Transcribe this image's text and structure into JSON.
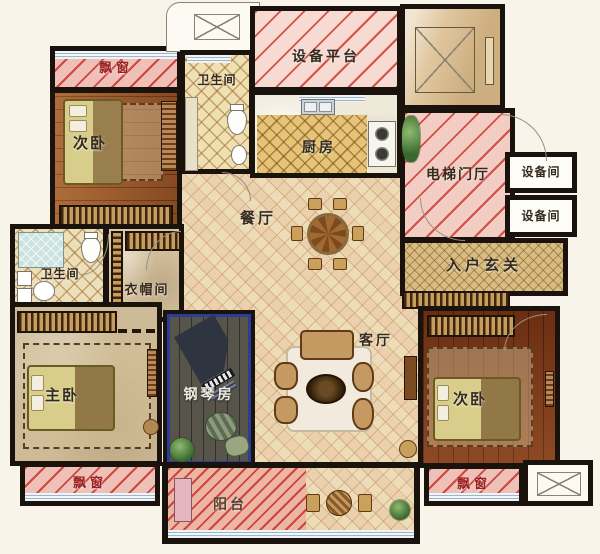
{
  "rooms": {
    "bay_top_left": {
      "label": "飘窗"
    },
    "bedroom_top_left": {
      "label": "次卧"
    },
    "bathroom_top": {
      "label": "卫生间"
    },
    "equipment_platform": {
      "label": "设备平台"
    },
    "kitchen": {
      "label": "厨房"
    },
    "elevator_hall": {
      "label": "电梯门厅"
    },
    "equipment_room_1": {
      "label": "设备间"
    },
    "equipment_room_2": {
      "label": "设备间"
    },
    "dining_room": {
      "label": "餐厅"
    },
    "entry_foyer": {
      "label": "入户玄关"
    },
    "bathroom_left": {
      "label": "卫生间"
    },
    "cloakroom": {
      "label": "衣帽间"
    },
    "piano_room": {
      "label": "钢琴房"
    },
    "living_room": {
      "label": "客厅"
    },
    "master_bedroom": {
      "label": "主卧"
    },
    "bedroom_right": {
      "label": "次卧"
    },
    "bay_bottom_left": {
      "label": "飘窗"
    },
    "bay_bottom_right": {
      "label": "飘窗"
    },
    "balcony": {
      "label": "阳台"
    }
  },
  "colors": {
    "background": "#f8f4e9",
    "wall": "#1a120c",
    "hatch_red": "#c93a31",
    "bay_pink": "#efc0b8",
    "platform_pink": "#f7dbd2",
    "hall_pink": "#f3cdc3",
    "balcony_pink": "#ecb5a4",
    "floor_lattice": "#eddcb8",
    "wood_brown": "#9c5628",
    "wood_red": "#7e3716",
    "piano_floor": "#57544a",
    "piano_border_blue": "#2b3d96",
    "label_red": "#9c2020",
    "label_dark": "#342a1d"
  }
}
